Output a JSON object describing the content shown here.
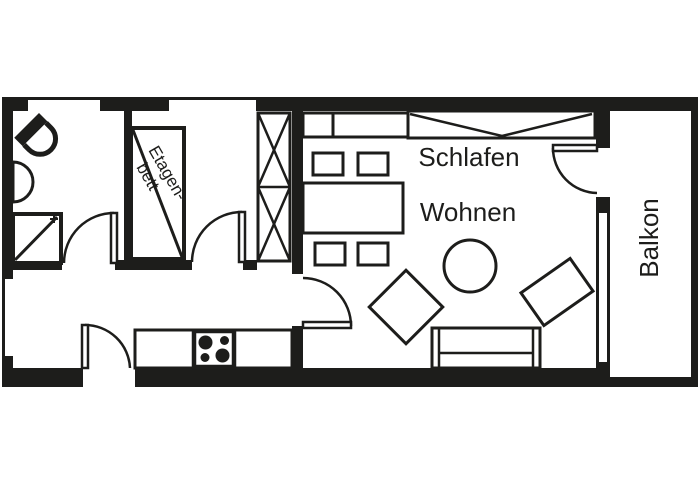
{
  "floorplan": {
    "labels": {
      "schlafen": "Schlafen",
      "wohnen": "Wohnen",
      "balkon": "Balkon",
      "bunk_bed_line1": "Etagen-",
      "bunk_bed_line2": "bett"
    },
    "colors": {
      "wall": "#1d1d1b",
      "floor": "#ffffff"
    }
  }
}
